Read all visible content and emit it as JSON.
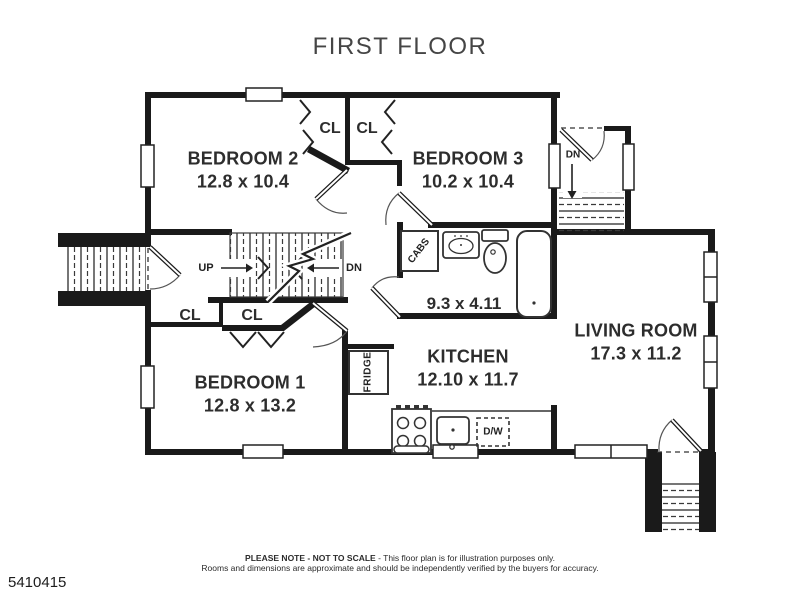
{
  "title": "FIRST FLOOR",
  "rooms": {
    "bedroom2": {
      "name": "BEDROOM 2",
      "dims": "12.8 x 10.4"
    },
    "bedroom3": {
      "name": "BEDROOM 3",
      "dims": "10.2 x 10.4"
    },
    "bedroom1": {
      "name": "BEDROOM 1",
      "dims": "12.8 x 13.2"
    },
    "kitchen": {
      "name": "KITCHEN",
      "dims": "12.10 x 11.7"
    },
    "living_room": {
      "name": "LIVING ROOM",
      "dims": "17.3 x 11.2"
    },
    "bathroom": {
      "dims": "9.3 x 4.11"
    }
  },
  "labels": {
    "closet": "CL",
    "up": "UP",
    "down": "DN",
    "cabinets": "CABS",
    "fridge": "FRIDGE",
    "dishwasher": "D/W"
  },
  "footer": {
    "note_bold": "PLEASE NOTE - NOT TO SCALE",
    "note_rest": " - This floor plan is for illustration purposes only.",
    "note_line2": "Rooms and dimensions are approximate and should be independently verified by the buyers for accuracy.",
    "listing_id": "5410415"
  },
  "colors": {
    "wall": "#1a1a1a",
    "label_text": "#2d2d2d"
  }
}
